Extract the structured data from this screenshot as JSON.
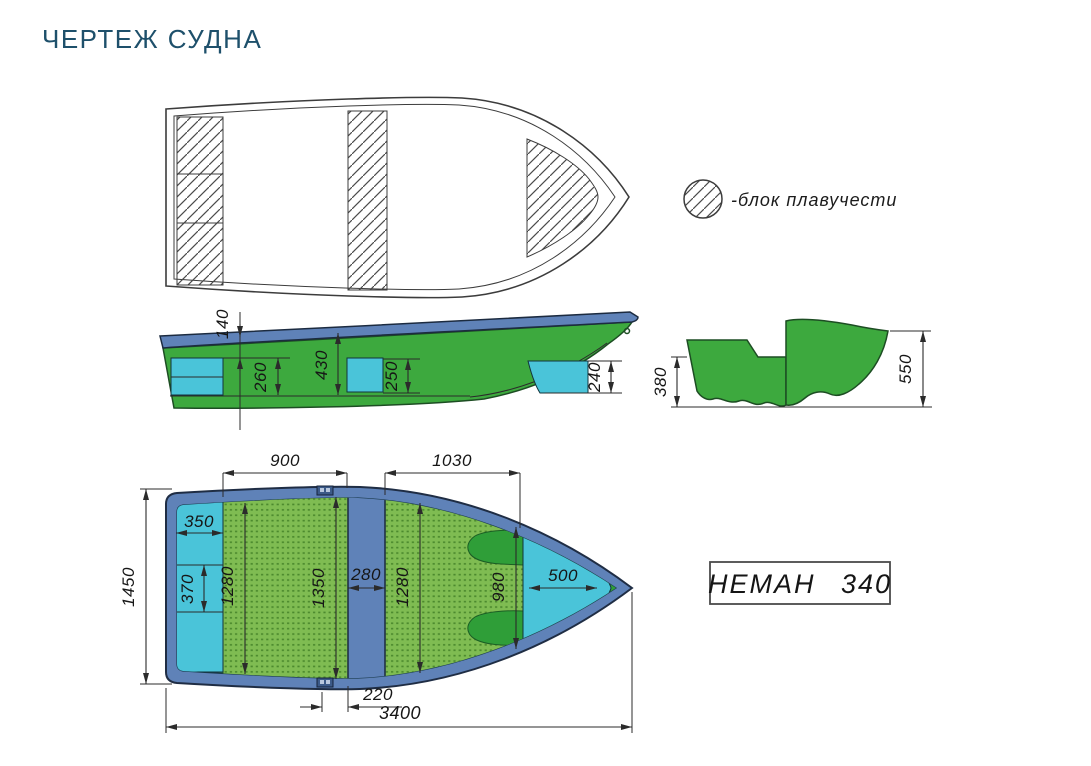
{
  "page": {
    "title": "ЧЕРТЕЖ СУДНА"
  },
  "legend": {
    "label": "-блок плавучести",
    "symbol": "hatched-circle"
  },
  "model": {
    "name": "НЕМАН 340"
  },
  "views": {
    "top": {
      "buoyancy_blocks_count": 3
    },
    "side": {
      "dims": {
        "d140": "140",
        "d260": "260",
        "d430": "430",
        "d250": "250",
        "d240": "240"
      }
    },
    "section": {
      "dims": {
        "d380": "380",
        "d550": "550"
      }
    },
    "plan": {
      "dims": {
        "d900": "900",
        "d1030": "1030",
        "d1450": "1450",
        "d350": "350",
        "d370": "370",
        "d1280a": "1280",
        "d1350": "1350",
        "d280": "280",
        "d1280b": "1280",
        "d980": "980",
        "d500": "500",
        "d220": "220",
        "d3400": "3400"
      }
    }
  },
  "colors": {
    "title": "#1e506b",
    "hull_green": "#3da93e",
    "deck_green": "#2f9e38",
    "floor_green": "#7fbc52",
    "floor_dot_green": "#4c8a2e",
    "gunwale_blue": "#5f82b8",
    "seat_cyan": "#4ac4d9",
    "outline": "#2b2b2b"
  }
}
